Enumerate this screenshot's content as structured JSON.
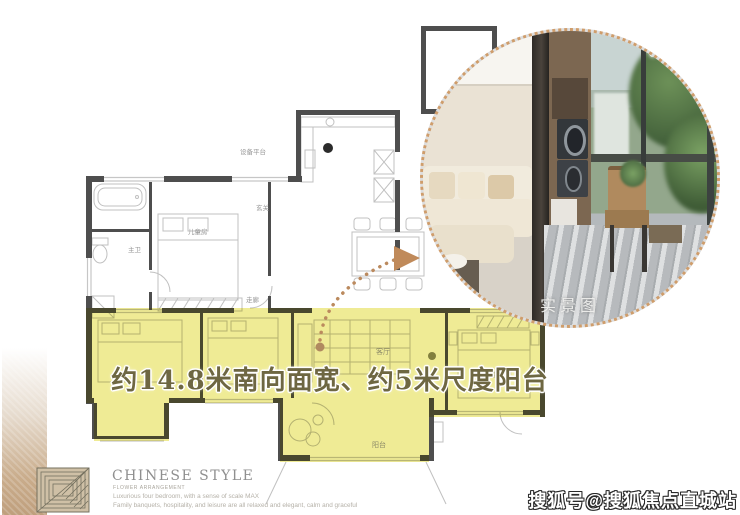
{
  "banner": {
    "text": "约14.8米南向面宽、约5米尺度阳台",
    "text_color": "#6e6742",
    "highlight_color": "#ece77e"
  },
  "photo_inset": {
    "caption": "实景图",
    "border_color": "#cf9d6b"
  },
  "floorplan": {
    "labels": {
      "equipment_platform": "设备平台",
      "entry": "玄关",
      "kids_room": "儿童房",
      "bath": "主卫",
      "corridor": "走廊",
      "living_room": "客厅",
      "balcony": "阳台",
      "master_bedroom": "主人房"
    },
    "wall_color": "#4e4e4e",
    "line_color": "#c0c0c0"
  },
  "leader": {
    "dot_color": "#b08a60",
    "arrow_color": "#c08a5a"
  },
  "footer": {
    "title": "CHINESE STYLE",
    "subtitle": "FLOWER ARRANGEMENT",
    "line1": "Luxurious four bedroom, with a sense of scale MAX",
    "line2": "Family banquets, hospitality, and leisure are all relaxed and elegant, calm and graceful"
  },
  "watermark": {
    "text": "搜狐号@搜狐焦点直城站"
  },
  "icons": {
    "arrow_icon": "right-pointing-triangle",
    "brand_logo_icon": "nested-square-line-pattern",
    "photo_border_icon": "dotted-circle"
  }
}
